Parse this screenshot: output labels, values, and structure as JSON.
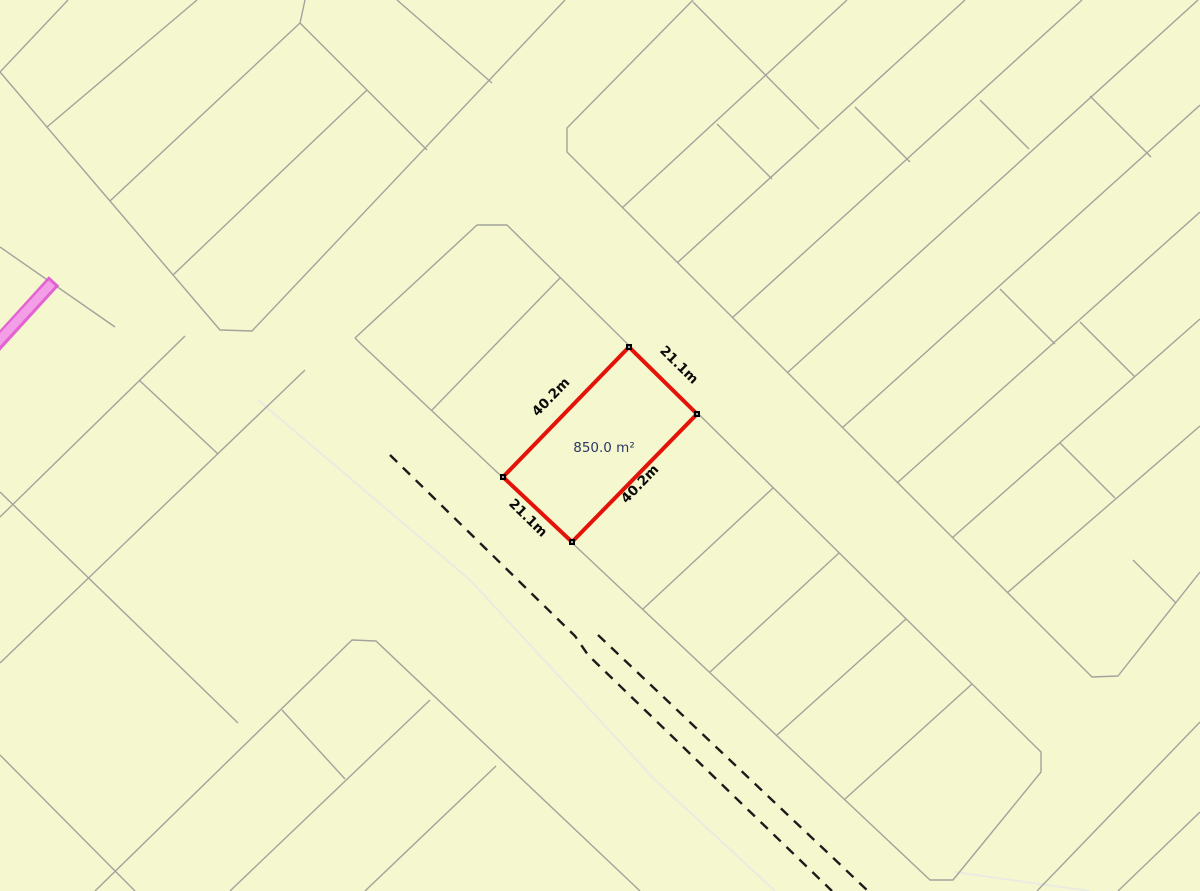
{
  "map": {
    "colors": {
      "background": "#f5f7cf",
      "parcel_line": "#a2a49c",
      "road_edge": "#eaebe1",
      "centerline": "#1b1b1b",
      "highlight": "#e31309",
      "corner_marker": "#000000",
      "dimension_label": "#0b0b0b",
      "area_label": "#2b3763",
      "selected_road_fill": "#f395ea",
      "selected_road_border": "#e054d2"
    },
    "parcel_lines": [
      [
        [
          0,
          72
        ],
        [
          220,
          330
        ],
        [
          252,
          331
        ],
        [
          565,
          0
        ]
      ],
      [
        [
          68,
          0
        ],
        [
          0,
          72
        ]
      ],
      [
        [
          197,
          0
        ],
        [
          47,
          127
        ]
      ],
      [
        [
          305,
          0
        ],
        [
          300,
          23
        ],
        [
          110,
          201
        ]
      ],
      [
        [
          300,
          23
        ],
        [
          427,
          150
        ]
      ],
      [
        [
          397,
          0
        ],
        [
          492,
          83
        ]
      ],
      [
        [
          173,
          275
        ],
        [
          367,
          90
        ]
      ],
      [
        [
          693,
          0
        ],
        [
          567,
          128
        ],
        [
          567,
          152
        ],
        [
          1092,
          677
        ],
        [
          1118,
          676
        ],
        [
          1200,
          572
        ]
      ],
      [
        [
          693,
          2
        ],
        [
          819,
          129
        ]
      ],
      [
        [
          622,
          208
        ],
        [
          847,
          0
        ]
      ],
      [
        [
          677,
          263
        ],
        [
          965,
          0
        ]
      ],
      [
        [
          732,
          318
        ],
        [
          1082,
          0
        ]
      ],
      [
        [
          787,
          373
        ],
        [
          1198,
          0
        ]
      ],
      [
        [
          842,
          428
        ],
        [
          1200,
          105
        ]
      ],
      [
        [
          897,
          483
        ],
        [
          1200,
          212
        ]
      ],
      [
        [
          952,
          538
        ],
        [
          1200,
          319
        ]
      ],
      [
        [
          1007,
          593
        ],
        [
          1200,
          426
        ]
      ],
      [
        [
          717,
          124
        ],
        [
          772,
          179
        ]
      ],
      [
        [
          855,
          107
        ],
        [
          910,
          162
        ]
      ],
      [
        [
          980,
          100
        ],
        [
          1029,
          149
        ]
      ],
      [
        [
          1090,
          96
        ],
        [
          1151,
          157
        ]
      ],
      [
        [
          1000,
          289
        ],
        [
          1055,
          344
        ]
      ],
      [
        [
          1080,
          322
        ],
        [
          1135,
          377
        ]
      ],
      [
        [
          1060,
          443
        ],
        [
          1115,
          498
        ]
      ],
      [
        [
          1133,
          560
        ],
        [
          1176,
          603
        ]
      ],
      [
        [
          355,
          338
        ],
        [
          362,
          345
        ],
        [
          930,
          880
        ],
        [
          953,
          880
        ],
        [
          1041,
          772
        ],
        [
          1041,
          752
        ],
        [
          507,
          225
        ],
        [
          477,
          225
        ],
        [
          355,
          338
        ]
      ],
      [
        [
          432,
          410
        ],
        [
          560,
          278
        ]
      ],
      [
        [
          643,
          609
        ],
        [
          773,
          488
        ]
      ],
      [
        [
          710,
          672
        ],
        [
          839,
          553
        ]
      ],
      [
        [
          777,
          735
        ],
        [
          906,
          619
        ]
      ],
      [
        [
          845,
          799
        ],
        [
          972,
          684
        ]
      ],
      [
        [
          0,
          517
        ],
        [
          140,
          380
        ],
        [
          185,
          336
        ]
      ],
      [
        [
          0,
          492
        ],
        [
          238,
          723
        ]
      ],
      [
        [
          0,
          663
        ],
        [
          305,
          370
        ]
      ],
      [
        [
          139,
          380
        ],
        [
          218,
          454
        ]
      ],
      [
        [
          0,
          755
        ],
        [
          135,
          891
        ]
      ],
      [
        [
          95,
          891
        ],
        [
          352,
          640
        ],
        [
          376,
          641
        ],
        [
          640,
          891
        ]
      ],
      [
        [
          230,
          891
        ],
        [
          430,
          700
        ]
      ],
      [
        [
          365,
          891
        ],
        [
          496,
          766
        ]
      ],
      [
        [
          282,
          710
        ],
        [
          345,
          779
        ]
      ],
      [
        [
          1037,
          891
        ],
        [
          1200,
          722
        ]
      ],
      [
        [
          1118,
          891
        ],
        [
          1200,
          812
        ]
      ],
      [
        [
          0,
          247
        ],
        [
          115,
          327
        ]
      ]
    ],
    "road_edge_lines": [
      [
        [
          258,
          400
        ],
        [
          470,
          580
        ],
        [
          655,
          780
        ],
        [
          775,
          891
        ]
      ],
      [
        [
          955,
          872
        ],
        [
          1090,
          891
        ]
      ]
    ],
    "centerlines": [
      [
        [
          390,
          455
        ],
        [
          575,
          636
        ],
        [
          588,
          655
        ],
        [
          832,
          891
        ]
      ],
      [
        [
          598,
          635
        ],
        [
          868,
          891
        ]
      ]
    ],
    "selected_road": {
      "x1": -16,
      "y1": 358,
      "x2": 54,
      "y2": 281
    },
    "highlighted_parcel": {
      "corners": [
        [
          629,
          347
        ],
        [
          697,
          414
        ],
        [
          572,
          542
        ],
        [
          503,
          477
        ]
      ],
      "area_label": {
        "text": "850.0 m²",
        "x": 604,
        "y": 452
      },
      "dimension_labels": [
        {
          "text": "40.2m",
          "x": 554,
          "y": 400,
          "angle": -46
        },
        {
          "text": "21.1m",
          "x": 676,
          "y": 368,
          "angle": 44.5
        },
        {
          "text": "40.2m",
          "x": 643,
          "y": 487,
          "angle": -46
        },
        {
          "text": "21.1m",
          "x": 525,
          "y": 521,
          "angle": 44.5
        }
      ]
    }
  }
}
